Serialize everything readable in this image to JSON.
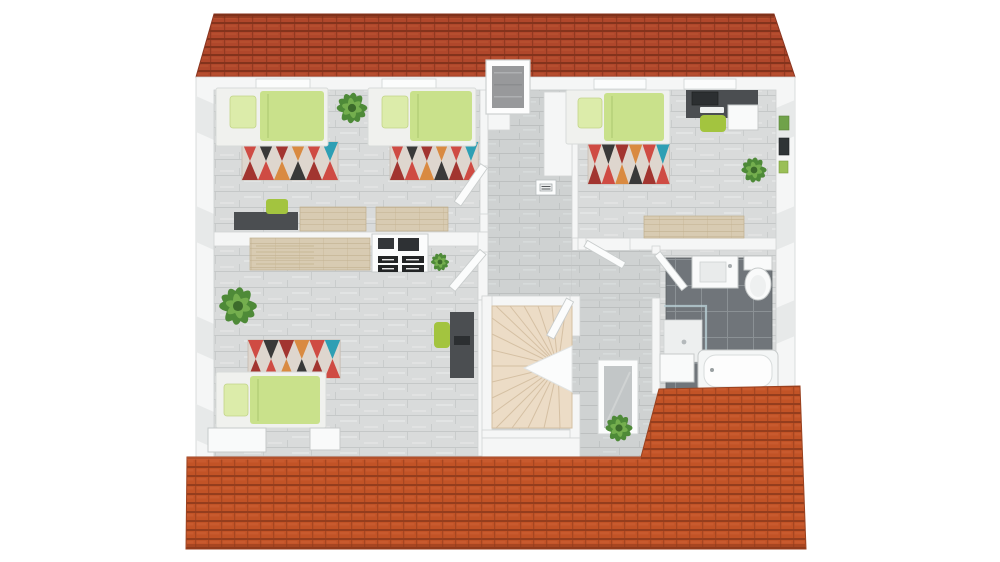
{
  "meta": {
    "title": "3D top-down floor plan render of an attic storey: three bedrooms, hallway with winder staircase, and a bathroom between two terracotta tiled roof slopes",
    "view": "top-down 3D architectural render",
    "visible_text": ""
  },
  "colors": {
    "bg": "#ffffff",
    "roof-top-base": "#b0472b",
    "roof-top-dark": "#7c2f1a",
    "roof-top-light": "#c05a36",
    "roof-bot-base": "#c25326",
    "roof-bot-dark": "#8c3a1b",
    "roof-bot-light": "#d2643a",
    "wall": "#f5f6f6",
    "wall-stroke": "#d2d5d5",
    "wall-shade": "#e6e8e8",
    "floor-base": "#d9dbdb",
    "floor-line": "#c5c8c8",
    "floor-streak": "#e4e6e6",
    "hall-base": "#cfd2d2",
    "hall-line": "#bdc0c0",
    "tile-dark": "#70757a",
    "tile-grout": "#8b9195",
    "wood": "#d8cbb2",
    "wood-line": "#c2b190",
    "stairs": "#ecdcc6",
    "stairs-line": "#d5c0a3",
    "duvet": "#c9e18b",
    "pillow": "#dcecaa",
    "bedframe": "#f0f1ee",
    "rug-base": "#ded6ce",
    "rug-red": "#cf4b43",
    "rug-crimson": "#a23530",
    "rug-orange": "#d98a41",
    "rug-teal": "#2e9fb4",
    "rug-dark": "#393939",
    "desk": "#4b4e51",
    "screen": "#2c2f31",
    "chair": "#a3c43f",
    "plant-dark": "#4e8a38",
    "plant-light": "#74ae4e",
    "fixture": "#f9fafa",
    "fixture-stroke": "#c6caca",
    "glass": "#b9d0d6",
    "chimney": "#98999b",
    "skylight": "#c2c6c7"
  },
  "scene": {
    "roofs": [
      {
        "id": "top-roof",
        "material": "red clay tiles"
      },
      {
        "id": "bottom-roof",
        "material": "orange clay tiles"
      }
    ],
    "rooms": [
      {
        "id": "bedroom-top-left",
        "floor": "light grey plank tiles",
        "furniture": [
          "single bed with lime duvet",
          "single bed with lime duvet",
          "red patterned rug",
          "red patterned rug",
          "potted plant",
          "dark desk",
          "green chair",
          "wooden sideboards"
        ]
      },
      {
        "id": "bedroom-top-right",
        "floor": "light grey plank tiles",
        "furniture": [
          "single bed with lime duvet",
          "red patterned rug",
          "dark desk with monitor",
          "green chair",
          "white cabinet",
          "potted plant",
          "wooden sideboard",
          "wall pictures"
        ]
      },
      {
        "id": "bedroom-bottom-left",
        "floor": "light grey plank tiles",
        "furniture": [
          "single bed with lime duvet",
          "red patterned rug",
          "large potted plant",
          "wooden counter",
          "white drawer unit",
          "small potted plant",
          "dark desk with monitor",
          "green chair",
          "white benches"
        ]
      },
      {
        "id": "bathroom",
        "floor": "dark grey tiles",
        "furniture": [
          "washbasin",
          "toilet",
          "glass shower",
          "bathtub",
          "low wall"
        ]
      },
      {
        "id": "hallway-landing",
        "floor": "grey plank tiles",
        "furniture": [
          "winder staircase",
          "chimney",
          "skylight frame",
          "potted plant",
          "wall thermostat",
          "interior doors",
          "closets"
        ]
      }
    ]
  }
}
